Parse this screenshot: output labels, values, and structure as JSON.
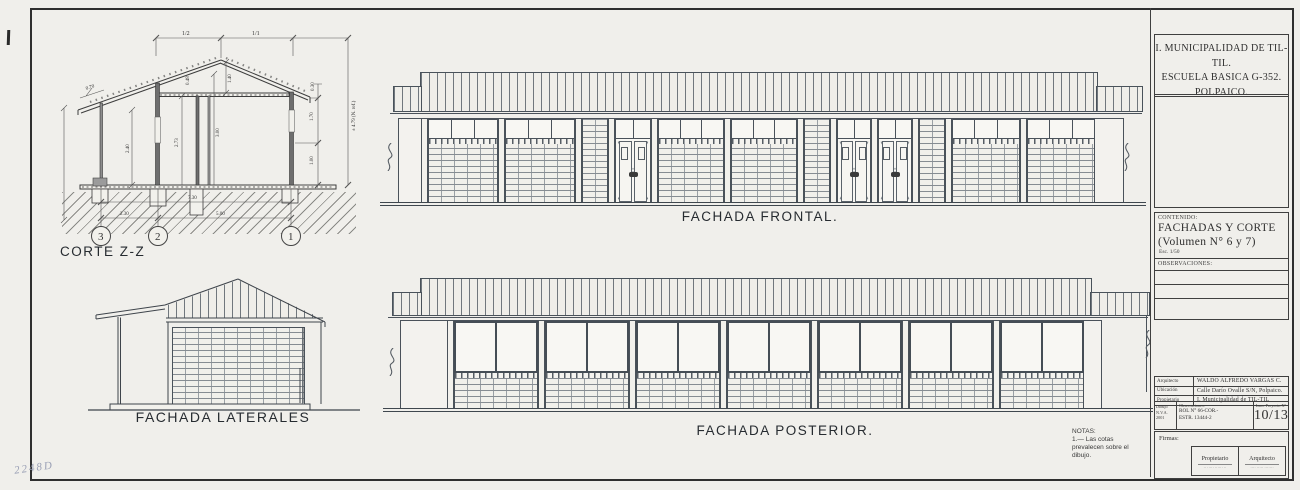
{
  "labels": {
    "corte": "CORTE Z-Z",
    "laterales": "FACHADA LATERALES",
    "frontal": "FACHADA FRONTAL.",
    "posterior": "FACHADA POSTERIOR."
  },
  "notas": {
    "title": "NOTAS:",
    "l1": "1.— Las cotas",
    "l2": "prevalecen sobre el",
    "l3": "dibujo."
  },
  "handwritten": "2248D",
  "corte_dims": {
    "pitch_left": "1/2",
    "pitch_right": "1/1",
    "eave": "0.30",
    "wall_upper": "1.70",
    "wall_lower": "1.00",
    "slope": "0.70",
    "porch_wall": "2.40",
    "ridge": "1.40",
    "purlin": "0.48",
    "room_a": "2.73",
    "room_b": "3.00",
    "total": "7.30",
    "span_porch": "2.30",
    "span_main": "5.00",
    "ref": "± 4.79 (N. ref.)",
    "axis_3": "3",
    "axis_2": "2",
    "axis_1": "1"
  },
  "title_block": {
    "header": {
      "l1": "I. MUNICIPALIDAD DE TIL-TIL.",
      "l2": "ESCUELA BASICA G-352.",
      "l3": "POLPAICO."
    },
    "contenido": {
      "label": "CONTENIDO:",
      "l1": "FACHADAS Y CORTE",
      "l2": "(Volumen N° 6 y 7)",
      "scale": "Esc. 1/50"
    },
    "observaciones_label": "OBSERVACIONES:",
    "rows": [
      {
        "label": "Arquitecto",
        "value": "WALDO ALFREDO VARGAS C."
      },
      {
        "label": "Ubicación",
        "value": "Calle Darío Ovalle S/N, Polpaico."
      },
      {
        "label": "Propietario",
        "value": "I. Municipalidad de TIL-TIL"
      }
    ],
    "meta": {
      "dibujo_l1": "Dibujo",
      "dibujo_l2": "N.V.A.",
      "dibujo_l3": "2001",
      "obs_label": "Observaciones:",
      "obs_l1": "ROL N° 66-COR.-",
      "obs_l2": "ESTR. 13444-2",
      "lam_label": "Lam. Proyecto N°",
      "lam_value": "10/13"
    },
    "firmas": {
      "label": "Firmas:",
      "owner_role": "Propietario",
      "owner_sub": "·· ····· ······ ··",
      "arch_role": "Arquitecto",
      "arch_sub": "···· ····· ·······"
    }
  }
}
